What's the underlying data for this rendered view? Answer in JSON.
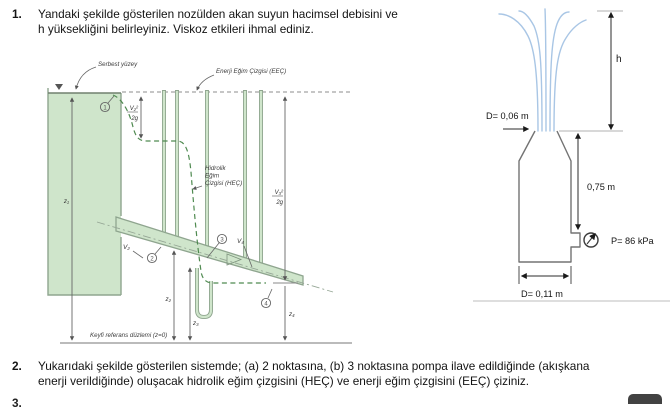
{
  "doc": {
    "q1_number": "1.",
    "q1_line1": "Yandaki şekilde gösterilen nozülden akan suyun hacimsel debisini ve",
    "q1_line2": "h yüksekliğini belirleyiniz. Viskoz etkileri ihmal ediniz.",
    "q2_number": "2.",
    "q2_line1": "Yukarıdaki şekilde gösterilen sistemde; (a) 2 noktasına, (b) 3 noktasına pompa ilave edildiğinde (akışkana",
    "q2_line2": "enerji verildiğinde) oluşacak hidrolik eğim çizgisini (HEÇ) ve enerji eğim çizgisini (EEÇ) çiziniz.",
    "q3_number_clipped": "3."
  },
  "figure_left": {
    "free_surface_label": "Serbest yüzey",
    "egl_label": "Enerji Eğim Çizgisi (EEÇ)",
    "hgl_label_l1": "Hidrolik",
    "hgl_label_l2": "Eğim",
    "hgl_label_l3": "Çizgisi (HEÇ)",
    "reference_label": "Keyfi referans düzlemi (z=0)",
    "frac_v2_num": "V₂²",
    "frac_v2_den": "2g",
    "frac_v3_num": "V₃²",
    "frac_v3_den": "2g",
    "z1": "z₁",
    "z2": "z₂",
    "z3": "z₃",
    "z4": "z₄",
    "v2": "V₂",
    "v4": "V₄",
    "pt1": "1",
    "pt2": "2",
    "pt3": "3",
    "pt4": "4",
    "colors": {
      "water": "#cfe5cb",
      "outline": "#8fa58f",
      "hgl": "#4f8a50",
      "egl": "#8c8c8c"
    }
  },
  "figure_right": {
    "d_top": "D= 0,06 m",
    "h": "h",
    "side_height": "0,75 m",
    "pressure": "P= 86 kPa",
    "d_bottom": "D= 0,11 m",
    "colors": {
      "jet": "#a9c6e5",
      "outline": "#737373"
    }
  }
}
